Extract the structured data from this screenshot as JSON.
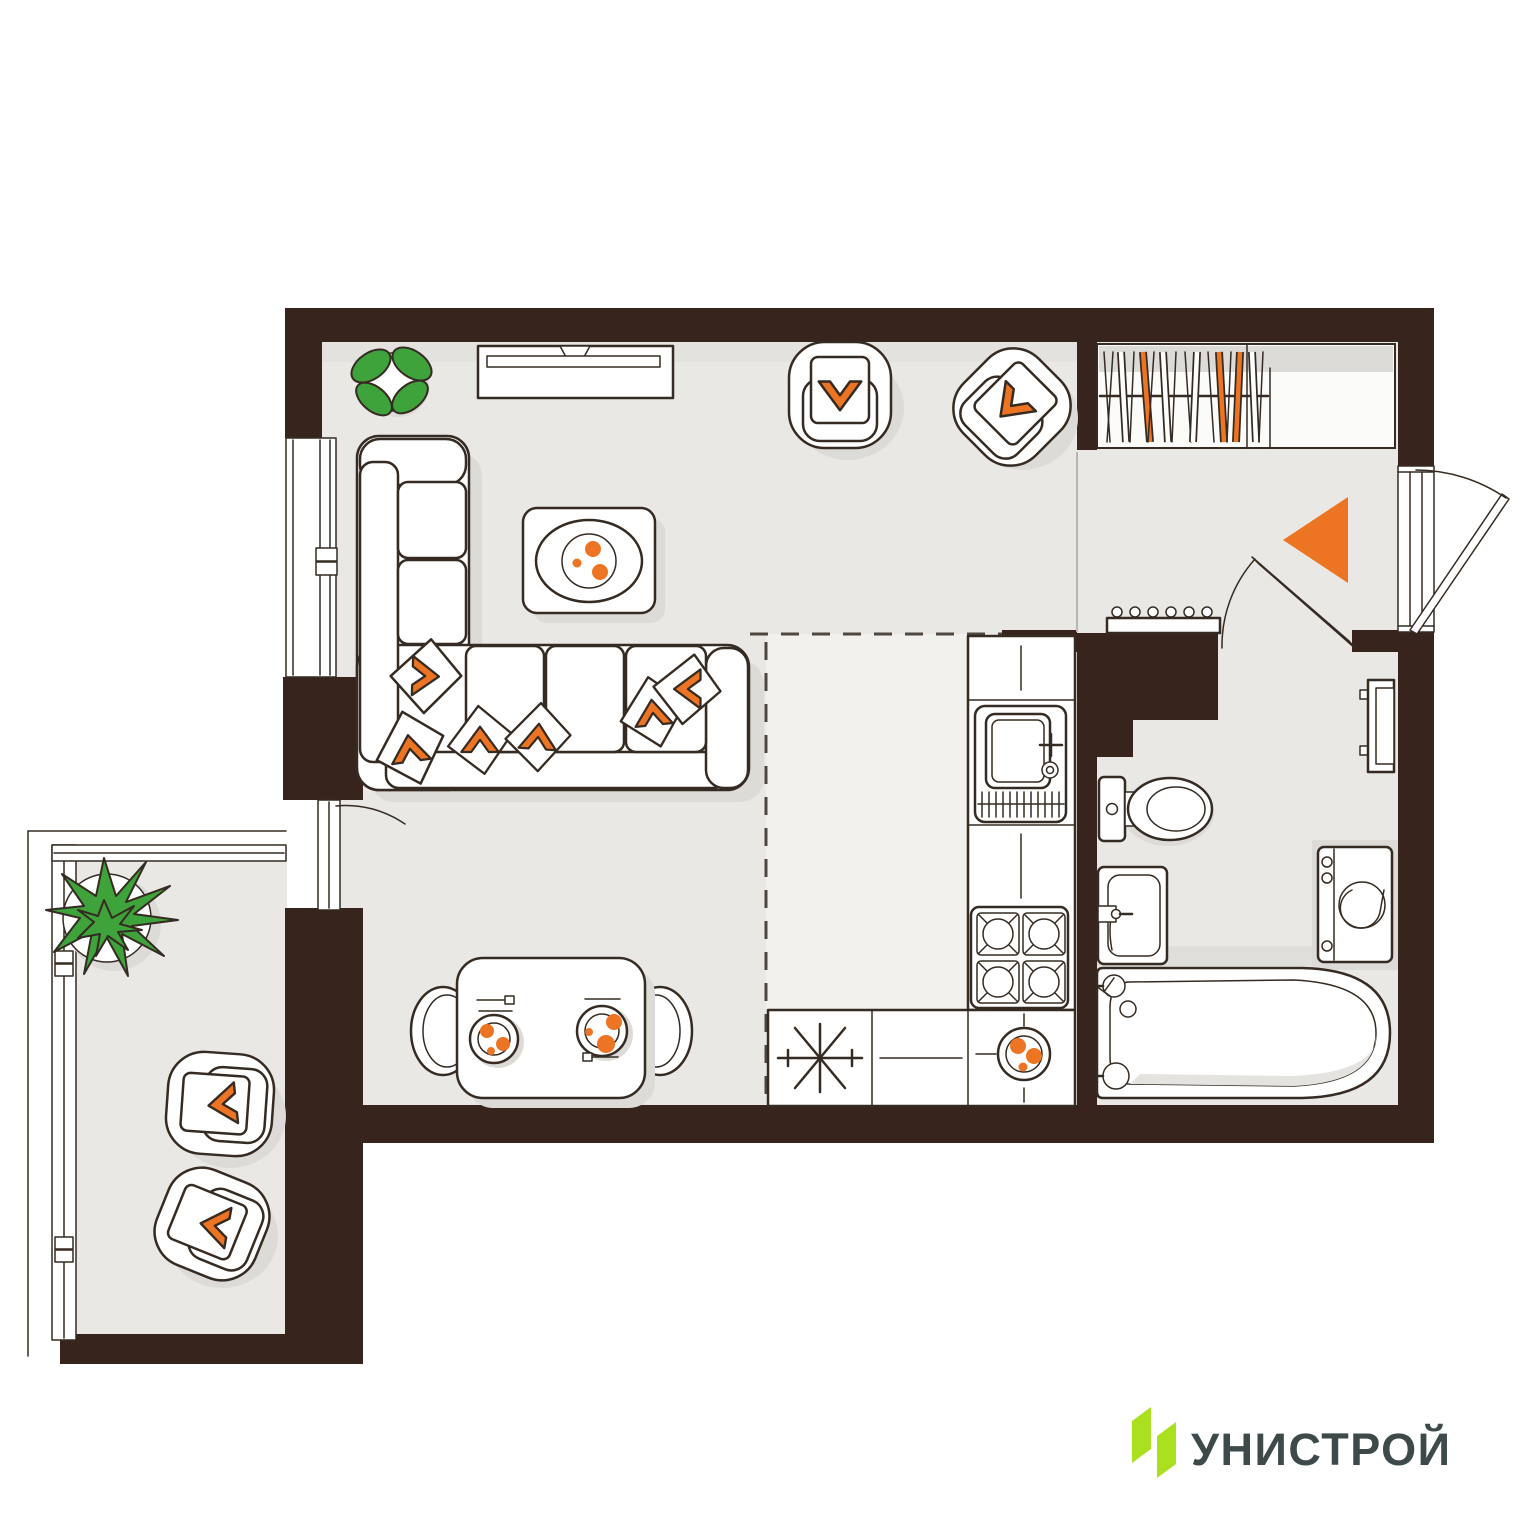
{
  "brand": {
    "logo_text": "УНИСТРОЙ"
  },
  "palette": {
    "wall": "#37241d",
    "floor": "#e9e8e5",
    "floor_kitchen": "#f2f1ee",
    "shadow": "#dcdbd7",
    "outline": "#352b22",
    "accent_orange": "#ed7423",
    "plant_green": "#3ea33b",
    "logo_green": "#abe01f",
    "logo_text_color": "#3e4a4a"
  },
  "plan": {
    "type": "studio-apartment-floor-plan",
    "rooms": [
      {
        "name": "living-room"
      },
      {
        "name": "kitchen-niche"
      },
      {
        "name": "hallway"
      },
      {
        "name": "bathroom"
      },
      {
        "name": "wardrobe-closet"
      },
      {
        "name": "balcony"
      }
    ],
    "icons": [
      "tv-stand-icon",
      "corner-sofa-icon",
      "pillow-chevron-icon",
      "coffee-table-icon",
      "armchair-icon",
      "potted-plant-icon",
      "wardrobe-hangers-icon",
      "entrance-arrow-icon",
      "shoe-bench-icon",
      "kitchen-sink-icon",
      "stove-4-burner-icon",
      "refrigerator-snowflake-icon",
      "fruit-bowl-icon",
      "dining-table-for-two-icon",
      "toilet-icon",
      "washbasin-icon",
      "washing-machine-icon",
      "towel-radiator-icon",
      "bathtub-icon",
      "door-swing-icon",
      "window-icon",
      "balcony-chair-icon"
    ]
  }
}
